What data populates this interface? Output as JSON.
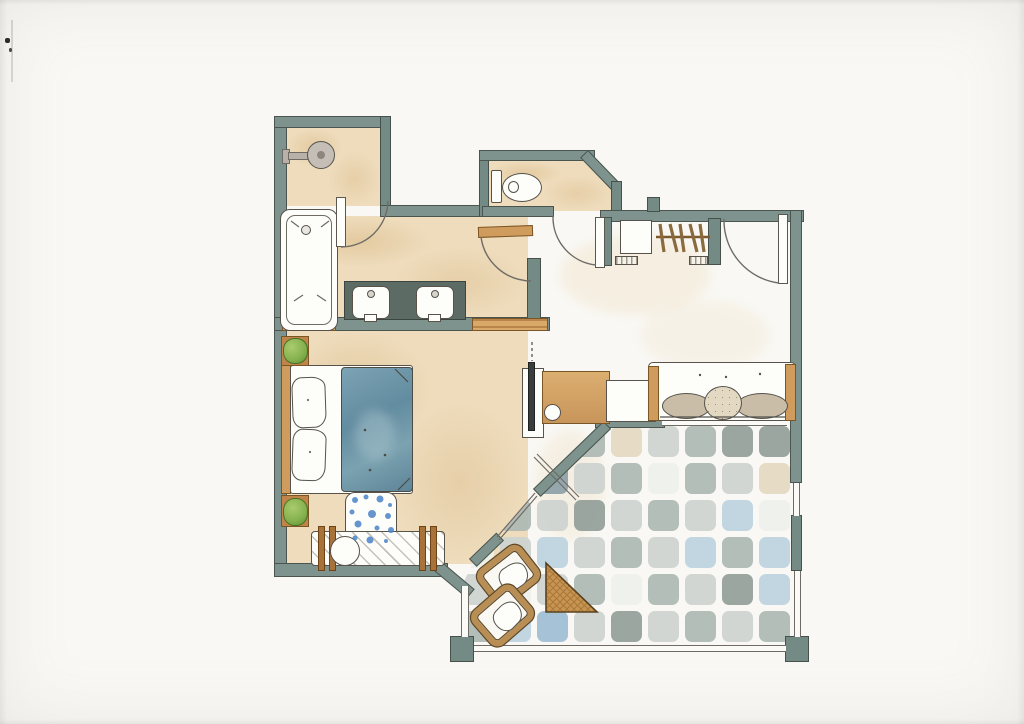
{
  "scene": {
    "type": "hand-drawn watercolor floor plan",
    "medium": "ink and watercolor on white scanned paper",
    "text_labels": []
  },
  "palette": {
    "paper": "#f9f8f4",
    "wall_fill": "#7e938d",
    "wall_outline": "#4a554f",
    "ink": "#55524b",
    "floor_tan": "#eedcbc",
    "wood": "#cf9c5e",
    "counter_dark": "#5c6b63",
    "fixture_white": "#fdfdfa",
    "duvet_blue": "#6b97aa",
    "rug_spot_blue": "#4b84c8",
    "plant_green": "#85b14e",
    "cushion_taupe": "#c9bda7",
    "tv_dark": "#3a3f3e"
  },
  "rooms": [
    {
      "id": "shower-room",
      "fixtures": [
        "shower-head"
      ]
    },
    {
      "id": "bathroom-corridor",
      "fixtures": [
        "bathtub",
        "vanity-counter",
        "sink-left",
        "sink-right",
        "wood-threshold-left",
        "wood-threshold-right"
      ]
    },
    {
      "id": "wc",
      "fixtures": [
        "toilet",
        "wc-door"
      ]
    },
    {
      "id": "entry-hall",
      "fixtures": [
        "entrance-door",
        "wardrobe-rod",
        "clothes-hangers",
        "shelf-box",
        "shoe-shelf-left",
        "shoe-shelf-right"
      ]
    },
    {
      "id": "bedroom",
      "fixtures": [
        "double-bed",
        "headboard",
        "pillows",
        "duvet",
        "plant-top",
        "plant-bottom",
        "rug",
        "luggage-bench"
      ]
    },
    {
      "id": "living-area",
      "fixtures": [
        "desk",
        "tv",
        "stool",
        "sofa",
        "bolster-cushions",
        "round-pillow"
      ]
    },
    {
      "id": "terrace",
      "fixtures": [
        "tiled-floor",
        "lounge-chair-1",
        "lounge-chair-2",
        "triangle-table",
        "glazing",
        "corner-posts"
      ]
    }
  ],
  "counts": {
    "hangers": 5,
    "bed_pillows": 2,
    "sofa_cushions": 3,
    "terrace_chairs": 2,
    "plants": 2,
    "sinks": 2,
    "doors": 4,
    "bench_hatch_lines": 9
  },
  "terrace": {
    "tile_palette": {
      "a": "#cdd3cf",
      "b": "#aeb8b3",
      "c": "#939e99",
      "d": "#e4d8bf",
      "e": "#bdd2de",
      "f": "#9dbdd2",
      "w": "#eef0ea",
      "g": "#8da0a8"
    },
    "tile_grid": [
      [
        "b",
        "a",
        "w",
        "b",
        "d",
        "a",
        "b",
        "c",
        "c"
      ],
      [
        "d",
        "a",
        "g",
        "a",
        "b",
        "w",
        "b",
        "a",
        "d"
      ],
      [
        "a",
        "b",
        "a",
        "c",
        "a",
        "b",
        "a",
        "e",
        "w"
      ],
      [
        "w",
        "a",
        "e",
        "a",
        "b",
        "a",
        "e",
        "b",
        "e"
      ],
      [
        "a",
        "w",
        "a",
        "b",
        "w",
        "b",
        "a",
        "c",
        "e"
      ],
      [
        "b",
        "e",
        "f",
        "a",
        "c",
        "a",
        "b",
        "a",
        "b"
      ]
    ]
  }
}
